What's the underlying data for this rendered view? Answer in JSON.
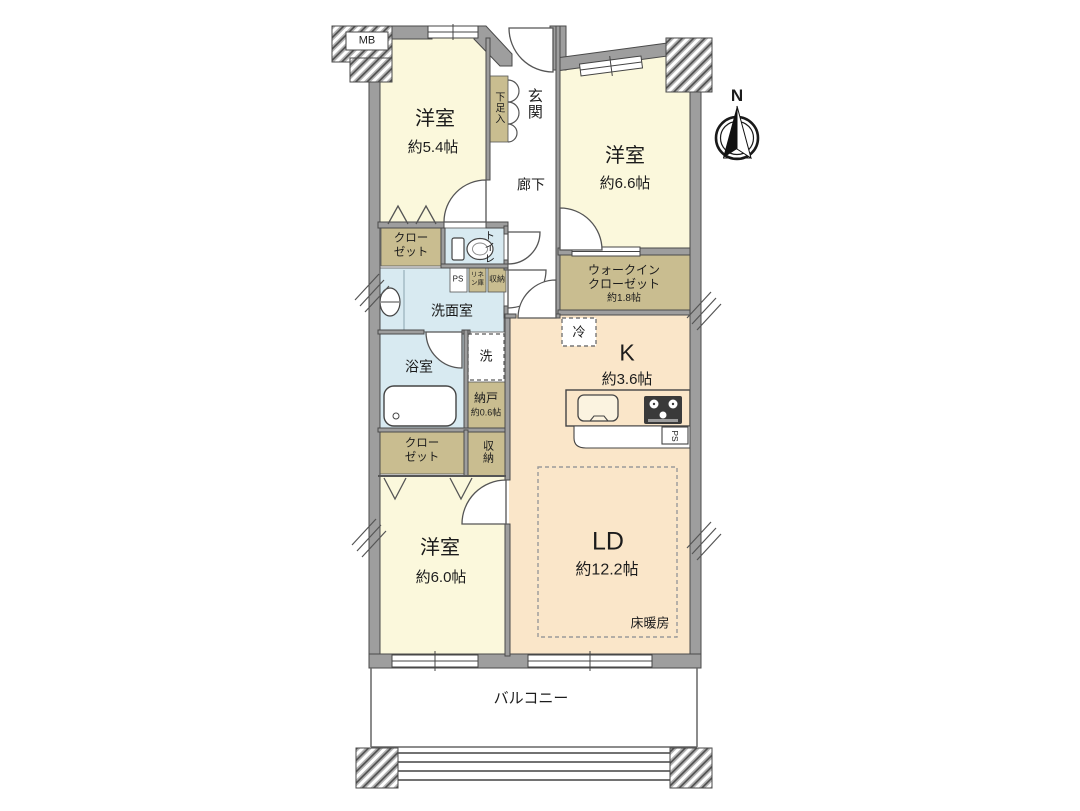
{
  "colors": {
    "room_cream": "#FBF8DC",
    "room_peach": "#FAE6C9",
    "room_water_blue": "#D8EAF1",
    "storage_tan": "#C9BD90",
    "wall_gray": "#9E9E9E",
    "line_dark": "#4a4a4a"
  },
  "rooms": {
    "mb": {
      "label": "MB"
    },
    "bedroom1": {
      "name": "洋室",
      "size": "約5.4帖"
    },
    "shoe_cabinet": {
      "label": "下足入"
    },
    "entrance": {
      "label": "玄関"
    },
    "corridor": {
      "label": "廊下"
    },
    "bedroom2": {
      "name": "洋室",
      "size": "約6.6帖"
    },
    "closet1": {
      "label": "クローゼット"
    },
    "toilet": {
      "label": "トイレ"
    },
    "pipe_space": {
      "label": "PS"
    },
    "linen": {
      "label": "リネン庫"
    },
    "storage_upper": {
      "label": "収納"
    },
    "washroom": {
      "label": "洗面室"
    },
    "walk_in_closet": {
      "name": "ウォークインクローゼット",
      "size": "約1.8帖"
    },
    "refrigerator": {
      "label": "冷"
    },
    "kitchen": {
      "name": "K",
      "size": "約3.6帖"
    },
    "bathroom": {
      "label": "浴室"
    },
    "washer": {
      "label": "洗"
    },
    "storeroom": {
      "name": "納戸",
      "size": "約0.6帖"
    },
    "closet2": {
      "label": "クローゼット"
    },
    "storage_lower": {
      "label": "収納"
    },
    "bedroom3": {
      "name": "洋室",
      "size": "約6.0帖"
    },
    "living_dining": {
      "name": "LD",
      "size": "約12.2帖"
    },
    "floor_heating": {
      "label": "床暖房"
    },
    "balcony": {
      "label": "バルコニー"
    },
    "kitchen_pipe_space": {
      "label": "PS"
    },
    "compass": {
      "label": "N"
    }
  }
}
